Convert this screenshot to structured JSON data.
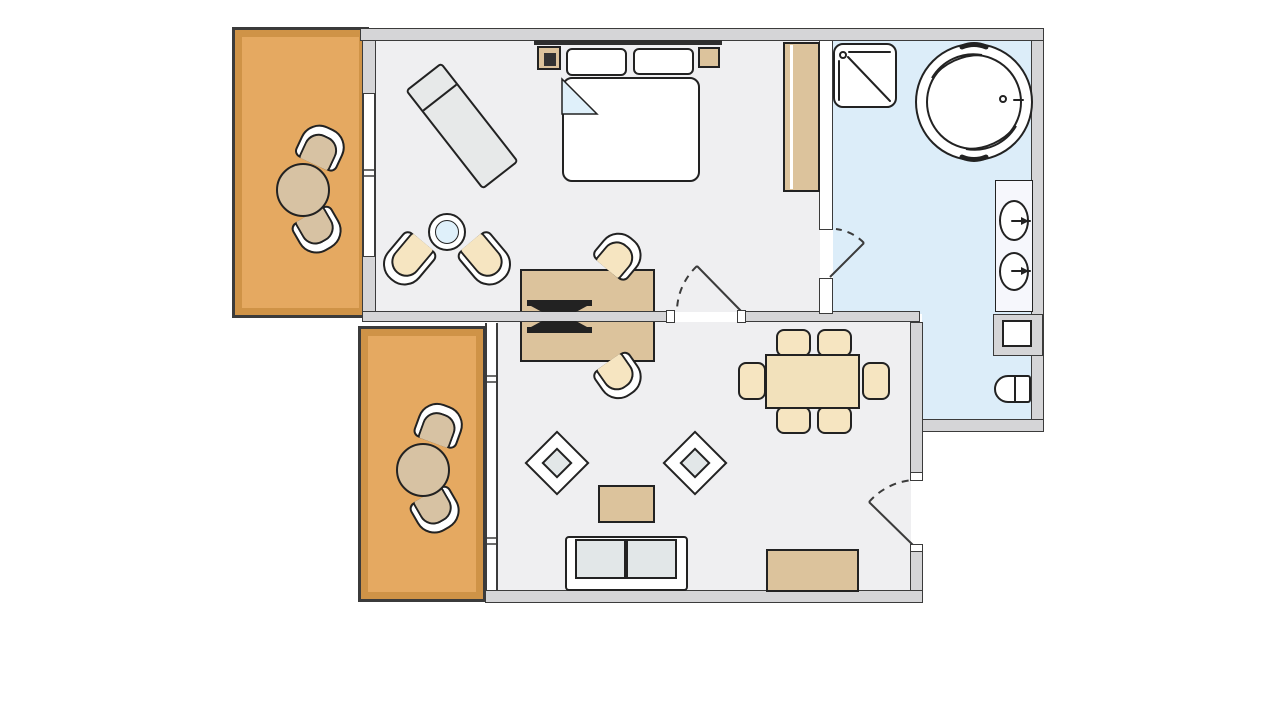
{
  "app": {
    "name": "apartment-suite-floor-plan",
    "visible_text": []
  },
  "colors": {
    "line": "#3b3b3b",
    "fline": "#222222",
    "wall_fill": "#d5d5d7",
    "room_floor": "#efeff1",
    "bath_floor": "#dcedf9",
    "balcony_floor": "#e5a961",
    "balcony_inner": "#cf9347",
    "wood": "#dcc39c",
    "wood_light": "#f2e1bb",
    "cream": "#f6e5c1",
    "tan": "#d7c2a3",
    "glass": "#dff0fa",
    "cushion": "#e2e7e8",
    "chaise": "#e7e9e9",
    "headboard": "#2e2e2e"
  },
  "plan": {
    "rooms": [
      {
        "name": "bedroom",
        "furniture": [
          "double-bed",
          "pillow",
          "pillow",
          "phone-nightstand",
          "nightstand",
          "wall-tv",
          "wardrobe",
          "chaise-longue",
          "glass-side-table",
          "tub-chair",
          "tub-chair",
          "double-sided-desk",
          "desk-chair",
          "desk-chair"
        ]
      },
      {
        "name": "bathroom",
        "furniture": [
          "shower",
          "round-whirlpool-tub",
          "vanity",
          "sink",
          "sink",
          "bidet",
          "toilet"
        ]
      },
      {
        "name": "living-room",
        "furniture": [
          "dining-table",
          "dining-chair",
          "dining-chair",
          "dining-chair",
          "dining-chair",
          "dining-chair",
          "dining-chair",
          "armchair",
          "armchair",
          "coffee-table",
          "sofa",
          "sideboard"
        ]
      },
      {
        "name": "balcony-upper",
        "furniture": [
          "round-table",
          "tub-chair",
          "tub-chair"
        ]
      },
      {
        "name": "balcony-lower",
        "furniture": [
          "round-table",
          "tub-chair",
          "tub-chair"
        ]
      }
    ],
    "doors": [
      "bedroom-to-living-room",
      "bedroom-to-bathroom",
      "entrance-to-living-room"
    ],
    "windows": [
      "bedroom-to-upper-balcony",
      "living-room-to-lower-balcony"
    ]
  }
}
